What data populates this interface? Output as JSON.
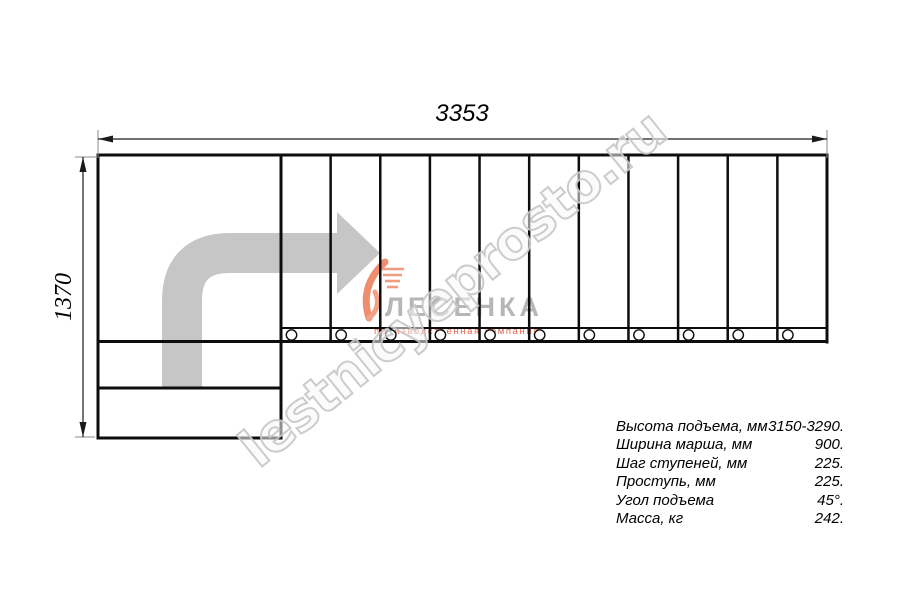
{
  "drawing": {
    "title": "staircase-plan-top-view",
    "top_dimension": "3353",
    "left_dimension": "1370"
  },
  "watermark": "lestnicyeprosto.ru",
  "logo": {
    "name": "ЛЕСЕНКА",
    "tagline": "производственная компания"
  },
  "specs": {
    "rows": [
      {
        "label": "Высота подъема, мм",
        "value": "3150-3290."
      },
      {
        "label": "Ширина марша, мм",
        "value": "900."
      },
      {
        "label": "Шаг ступеней, мм",
        "value": "225."
      },
      {
        "label": "Проступь, мм",
        "value": "225."
      },
      {
        "label": "Угол подъема",
        "value": "45°."
      },
      {
        "label": "Масса, кг",
        "value": "242."
      }
    ]
  },
  "colors": {
    "line": "#0d0d0d",
    "arrow_gray": "#c6c6c6",
    "watermark_gray": "#c6c6c6",
    "logo_gray": "#b6b6b6",
    "logo_accent": "#ef8d6f",
    "tagline_red": "#de3e26"
  }
}
